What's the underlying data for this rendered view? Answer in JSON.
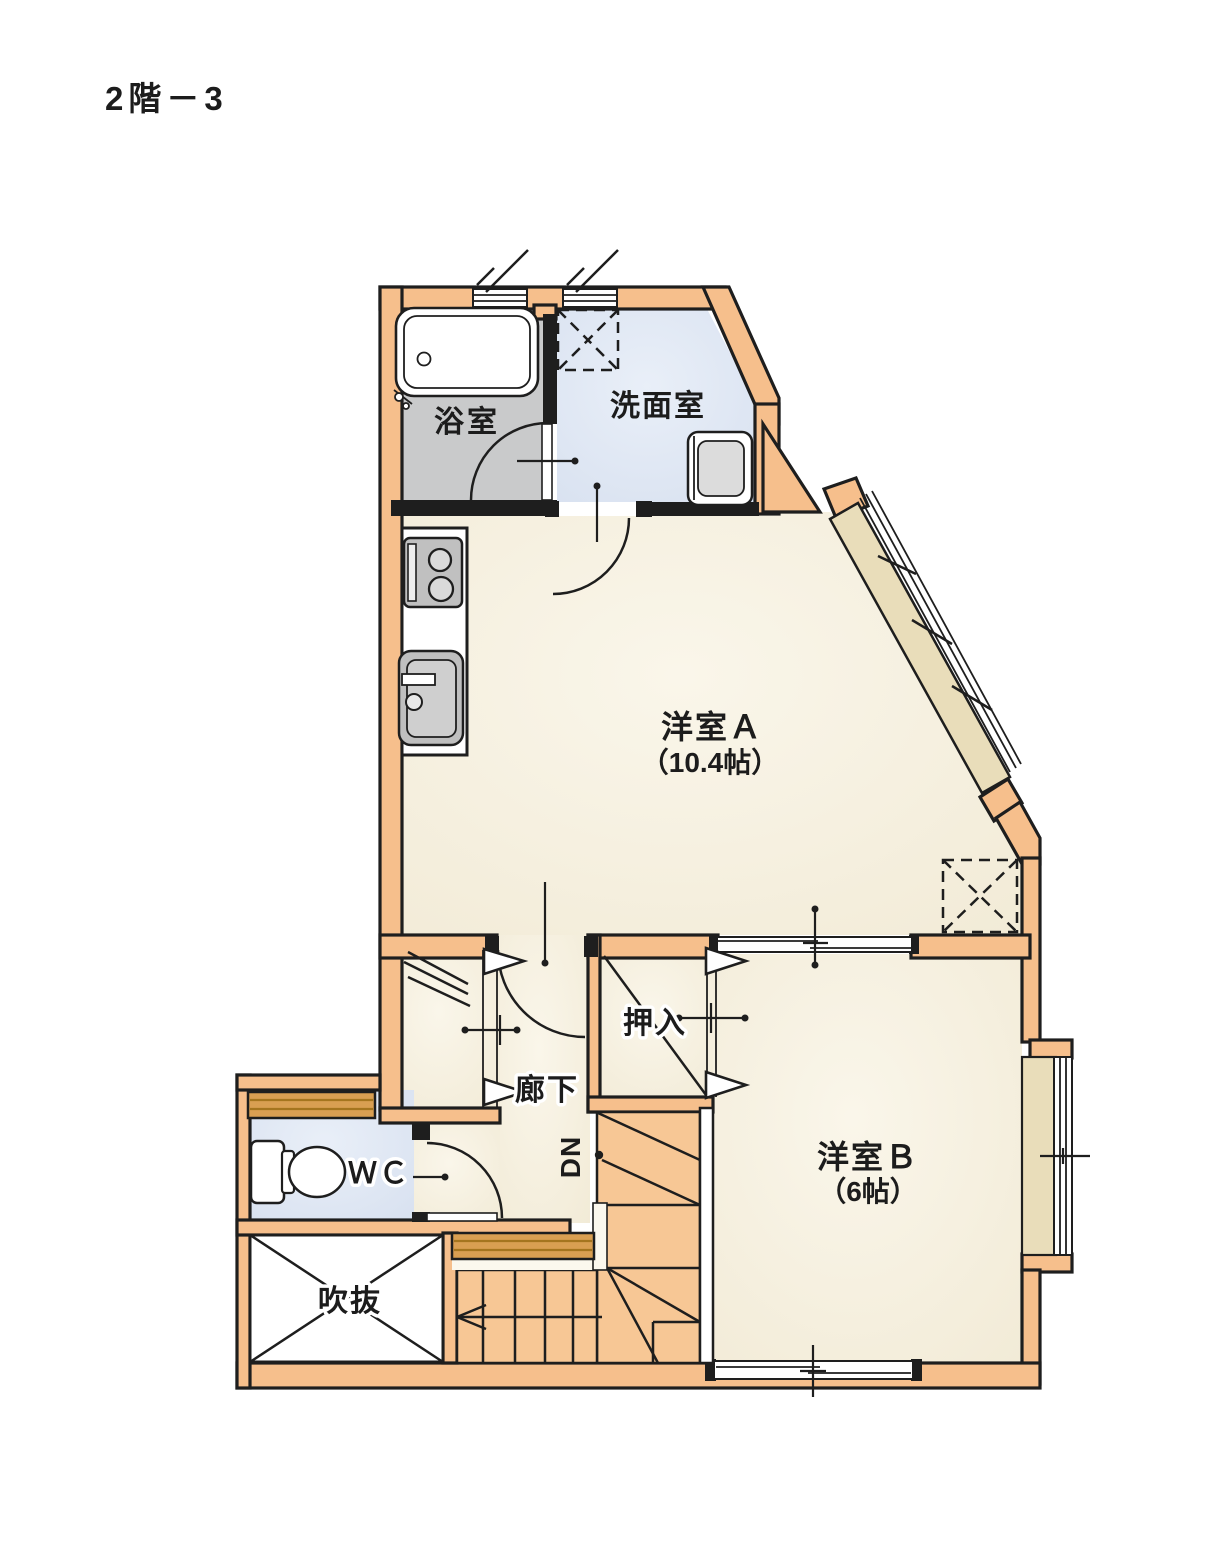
{
  "title": "2階－3",
  "labels": {
    "bath": "浴室",
    "washroom": "洗面室",
    "room_a": "洋室Ａ",
    "room_a_size": "（10.4帖）",
    "closet": "押入",
    "hallway": "廊下",
    "wc": "ＷＣ",
    "void_space": "吹抜",
    "room_b": "洋室Ｂ",
    "room_b_size": "（6帖）",
    "stairs_direction": "DN"
  },
  "colors": {
    "wall": "#F6BF8C",
    "outline": "#1e1e1e",
    "room_floor": "#F6F0DF",
    "bath_floor": "#C9CACB",
    "wet_floor": "#DFE7F4",
    "window_sill": "#E9DDBA",
    "counter": "#D99F52",
    "stairs": "#F7C795"
  }
}
